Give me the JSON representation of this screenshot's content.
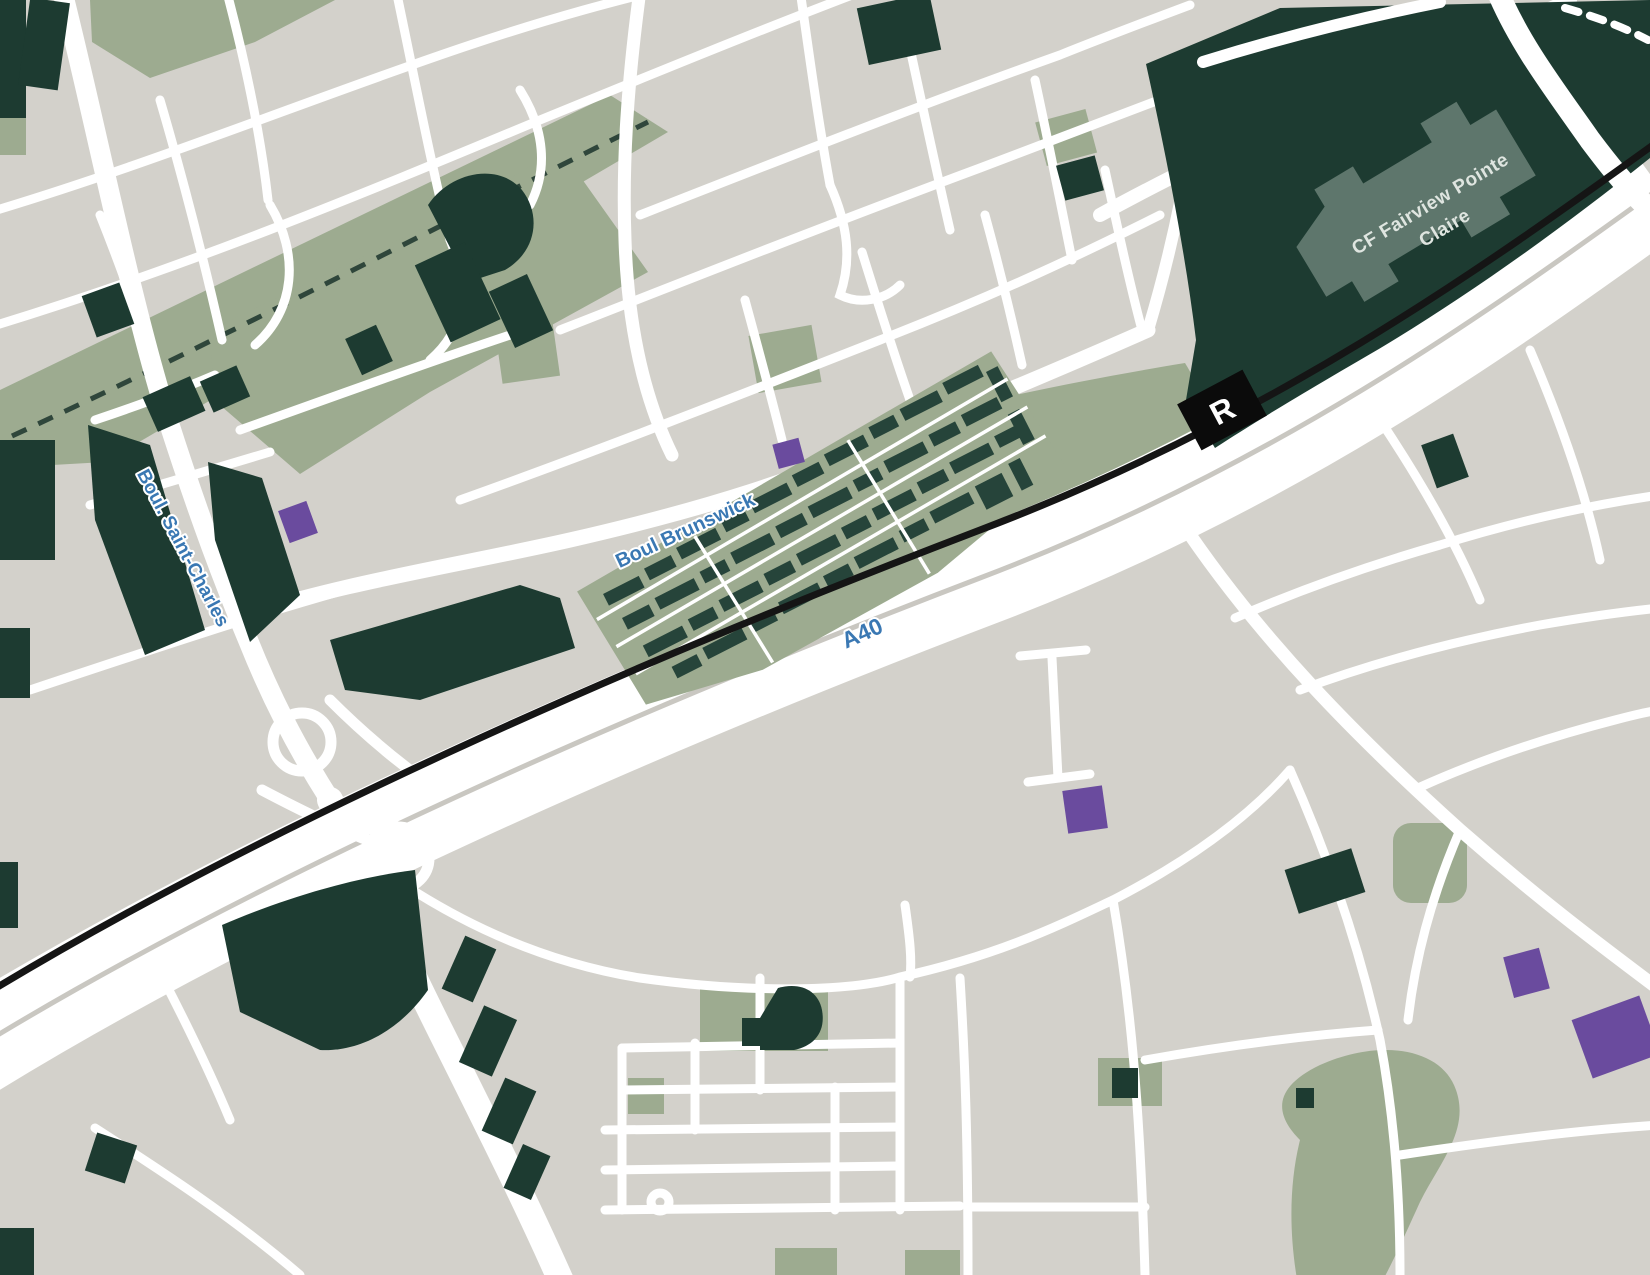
{
  "map": {
    "description": "stylized-city-map",
    "labels": {
      "highway": "A40",
      "road_brunswick": "Boul Brunswick",
      "road_saint_charles": "Boul. Saint-Charles",
      "mall_line1": "CF Fairview Pointe",
      "mall_line2": "Claire",
      "station_letter": "R"
    },
    "colors": {
      "background": "#d3d1cb",
      "road": "#ffffff",
      "building_dark": "#1d3b31",
      "site_building": "#26443a",
      "green_area": "#9dab90",
      "rail_line": "#151515",
      "road_label_blue": "#3a78b3",
      "mall_footprint": "#5e766c",
      "mall_label_light": "#dfe5e0",
      "highlight_purple": "#6a4b9e"
    }
  }
}
